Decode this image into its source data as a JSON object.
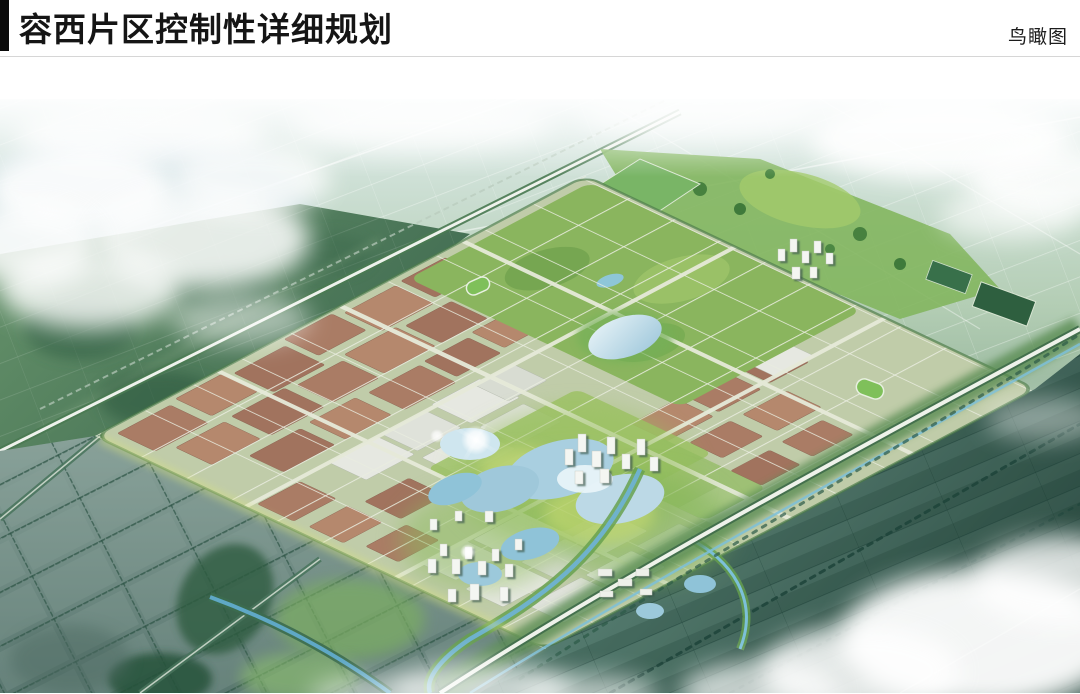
{
  "header": {
    "title": "容西片区控制性详细规划",
    "corner_label": "鸟瞰图"
  },
  "figure": {
    "label": "鸟瞰图",
    "type": "aerial-rendering",
    "palette": {
      "sky_haze": "#e8f1ee",
      "farmland_light": "#a9c7ae",
      "farmland_dark": "#2c5248",
      "polder_slate": "#74908a",
      "forest_green": "#4e7c58",
      "city_base": "#c0cca9",
      "street_light": "#e9ecdf",
      "roof_red": "#aa7c65",
      "building_white": "#f4f6f2",
      "park_green": "#8ab55e",
      "lake_blue": "#a9cfe0",
      "river_blue": "#64aecb",
      "cloud_white": "#ffffff"
    }
  }
}
